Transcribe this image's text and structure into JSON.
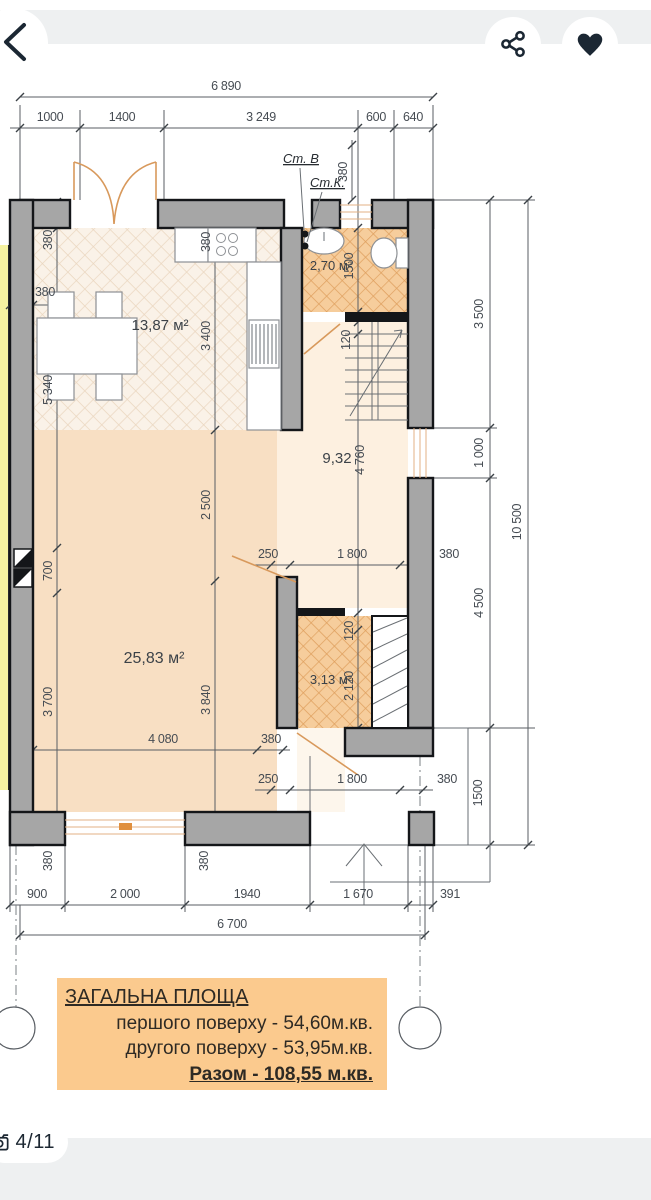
{
  "header": {
    "icons": {
      "back": "chevron-left",
      "share": "share-nodes",
      "favorite": "heart-filled"
    }
  },
  "plan": {
    "labels": {
      "st_v": "Ст. В",
      "st_k": "Ст.К."
    },
    "rooms": {
      "kitchen": "13,87 м²",
      "bathroom": "2,70 м²",
      "hall": "9,32",
      "living": "25,83 м²",
      "storage": "3,13 м²"
    },
    "dims": {
      "top_total": "6 890",
      "top_chain": [
        "1000",
        "1400",
        "3 249",
        "600",
        "640"
      ],
      "right_chain": [
        "3 500",
        "1 000",
        "4 500",
        "1500"
      ],
      "right_total": "10 500",
      "bottom_chain": [
        "900",
        "2 000",
        "1940",
        "1 670",
        "391"
      ],
      "bottom_total": "6 700",
      "d380": "380",
      "d5340": "5 340",
      "d3400": "3 400",
      "d2500": "2 500",
      "d700": "700",
      "d3700": "3 700",
      "d3840": "3 840",
      "d4080": "4 080",
      "d4760": "4 760",
      "d1500": "1500",
      "d120": "120",
      "d2120": "2 120",
      "d250": "250",
      "d1800": "1 800"
    }
  },
  "summary": {
    "title": "ЗАГАЛЬНА ПЛОЩА",
    "first_floor": "першого поверху - 54,60м.кв.",
    "second_floor": "другого поверху - 53,95м.кв.",
    "total": "Разом - 108,55 м.кв."
  },
  "footer": {
    "photo_counter": "4/11"
  },
  "colors": {
    "accent_peach": "#fbca8e",
    "wall_gray": "#a6a6a6",
    "floor_peach": "#f8dfc3",
    "floor_orange": "#f2c490",
    "neighbor_yellow": "#f5f2a1",
    "icon_dark": "#1b2733",
    "band_gray": "#eef0f1"
  }
}
